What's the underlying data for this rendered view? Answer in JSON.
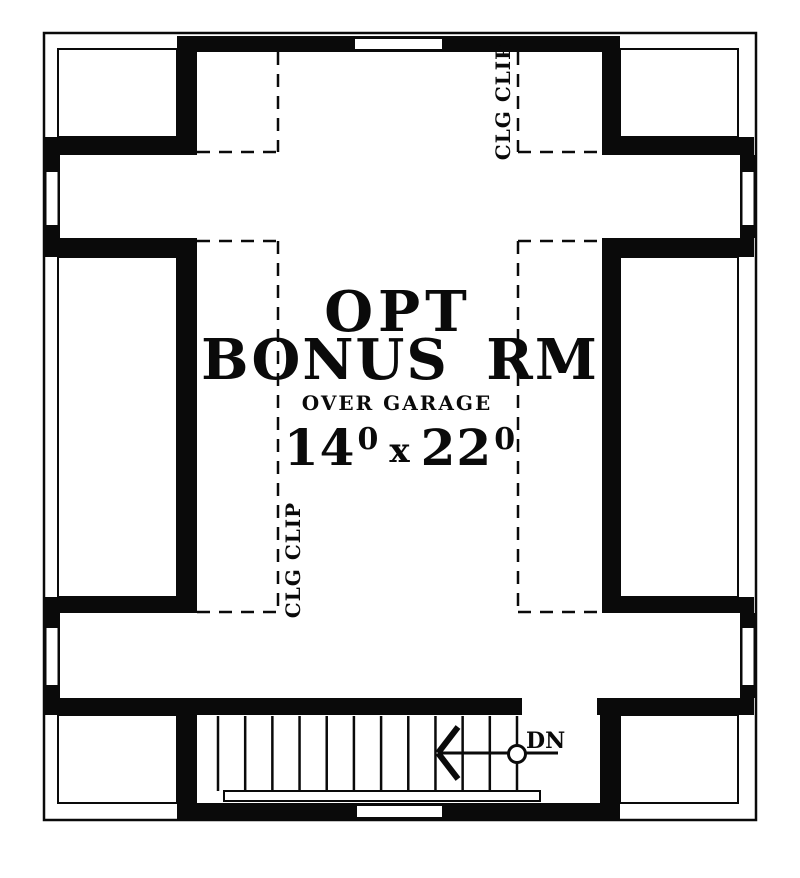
{
  "plan": {
    "room": {
      "title_line1": "OPT",
      "title_line2": "BONUS RM",
      "subtitle": "OVER GARAGE",
      "dimensions": {
        "width_ft": "14",
        "width_in": "0",
        "separator": "x",
        "length_ft": "22",
        "length_in": "0"
      }
    },
    "ceiling": {
      "clip_label_top_right": "CLG CLIP",
      "clip_label_left": "CLG CLIP"
    },
    "stairs": {
      "direction_label": "DN",
      "tread_count": 12
    },
    "colors": {
      "ink": "#0a0a0a",
      "paper": "#ffffff"
    }
  }
}
